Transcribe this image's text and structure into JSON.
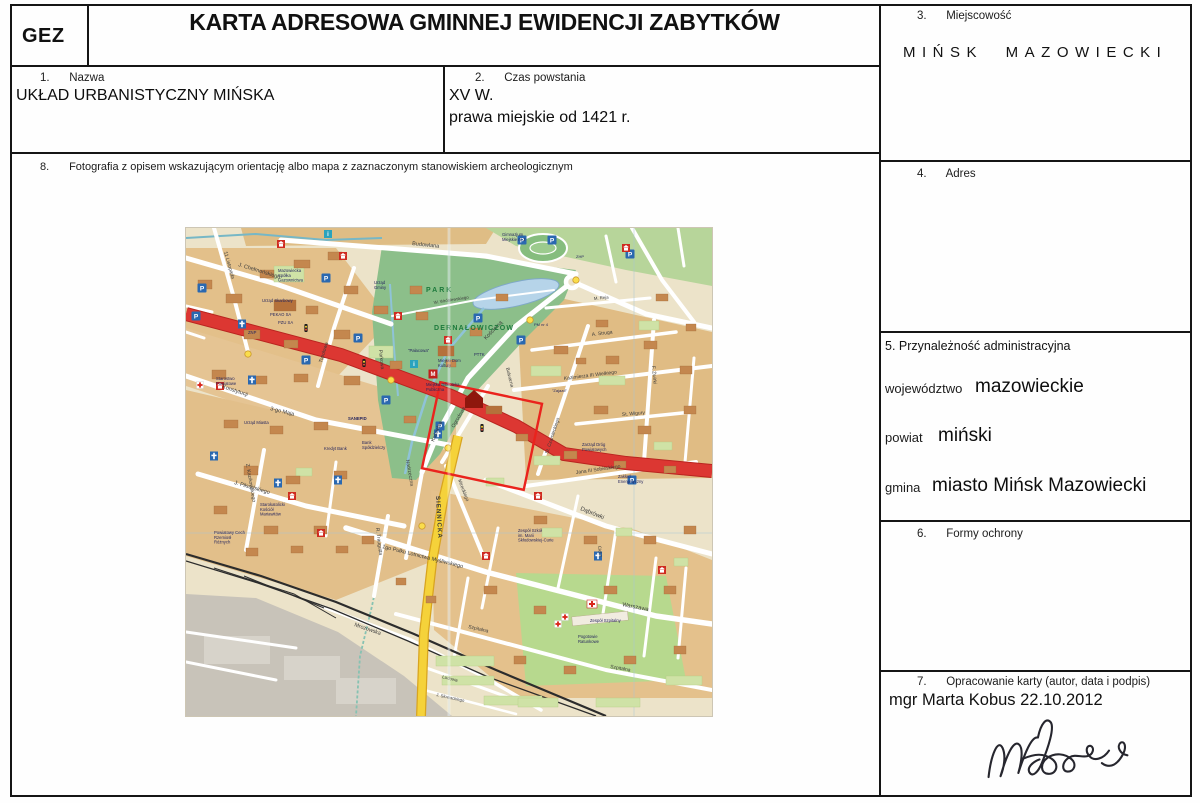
{
  "doc": {
    "gez": "GEZ",
    "title": "KARTA ADRESOWA GMINNEJ EWIDENCJI ZABYTKÓW"
  },
  "fields": {
    "nazwa": {
      "num": "1.",
      "label": "Nazwa",
      "value": "UKŁAD URBANISTYCZNY MIŃSKA"
    },
    "czas": {
      "num": "2.",
      "label": "Czas powstania",
      "value1": "XV W.",
      "value2": "prawa miejskie od 1421 r."
    },
    "miejscowosc": {
      "num": "3.",
      "label": "Miejscowość",
      "value": "MIŃSK MAZOWIECKI"
    },
    "adres": {
      "num": "4.",
      "label": "Adres"
    },
    "przynaleznosc": {
      "label": "5. Przynależność administracyjna",
      "rows": [
        {
          "label": "województwo",
          "value": "mazowieckie"
        },
        {
          "label": "powiat",
          "value": "miński"
        },
        {
          "label": "gmina",
          "value": "miasto Mińsk Mazowiecki"
        }
      ]
    },
    "formy": {
      "num": "6.",
      "label": "Formy ochrony"
    },
    "opracowanie": {
      "num": "7.",
      "label": "Opracowanie karty (autor, data i podpis)",
      "value": "mgr Marta Kobus 22.10.2012"
    },
    "fotografia": {
      "num": "8.",
      "label": "Fotografia z opisem wskazującym orientację albo mapa z zaznaczonym stanowiskiem archeologicznym"
    }
  },
  "map": {
    "colors": {
      "base": "#ece3c9",
      "block": "#e2c08a",
      "park": "#8cbf8a",
      "water": "#b6d4e9",
      "road_red": "#dc3732",
      "road_yellow": "#f5d23a",
      "rail": "#2c2c2c",
      "monument_outline": "#ea231d",
      "industrial": "#c8c3b9"
    },
    "labels": [
      {
        "t": "J. Chełmońskiego",
        "x": 52,
        "y": 38,
        "r": 17,
        "s": 5.5
      },
      {
        "t": "11 Listopada",
        "x": 38,
        "y": 24,
        "r": 74,
        "s": 5
      },
      {
        "t": "Topolowa",
        "x": 136,
        "y": 135,
        "r": -73,
        "s": 5
      },
      {
        "t": "Budowlana",
        "x": 226,
        "y": 17,
        "r": 6,
        "s": 5.5
      },
      {
        "t": "W. Wróblewskiego",
        "x": 248,
        "y": 76,
        "r": -9,
        "s": 4.3
      },
      {
        "t": "Kościelna",
        "x": 300,
        "y": 112,
        "r": -46,
        "s": 5.5
      },
      {
        "t": "Kościelna",
        "x": 248,
        "y": 214,
        "r": -68,
        "s": 5
      },
      {
        "t": "Parkowa",
        "x": 193,
        "y": 122,
        "r": 84,
        "s": 5
      },
      {
        "t": "Konstytucji",
        "x": 36,
        "y": 160,
        "r": 18,
        "s": 5.5
      },
      {
        "t": "3-go Maja",
        "x": 84,
        "y": 182,
        "r": 14,
        "s": 5.5
      },
      {
        "t": "Z. Kazikowskiego",
        "x": 60,
        "y": 236,
        "r": 80,
        "s": 5
      },
      {
        "t": "J. Piłsudskiego",
        "x": 48,
        "y": 256,
        "r": 16,
        "s": 5.5
      },
      {
        "t": "R. Traugutta",
        "x": 190,
        "y": 300,
        "r": 83,
        "s": 5
      },
      {
        "t": "Mireckiego",
        "x": 272,
        "y": 252,
        "r": 69,
        "s": 4.8
      },
      {
        "t": "Nadrzeczna",
        "x": 220,
        "y": 232,
        "r": 80,
        "s": 5
      },
      {
        "t": "Ogrodowa",
        "x": 268,
        "y": 200,
        "r": -60,
        "s": 5
      },
      {
        "t": "St. Czarnieckiego",
        "x": 362,
        "y": 226,
        "r": -72,
        "s": 4.8
      },
      {
        "t": "M. Reja",
        "x": 408,
        "y": 72,
        "r": -6,
        "s": 4.3
      },
      {
        "t": "A. Struga",
        "x": 406,
        "y": 108,
        "r": -7,
        "s": 5
      },
      {
        "t": "Kazimierza III Wielkiego",
        "x": 378,
        "y": 152,
        "r": -7,
        "s": 5
      },
      {
        "t": "F. Żwirki",
        "x": 466,
        "y": 138,
        "r": 85,
        "s": 5
      },
      {
        "t": "St. Wigury",
        "x": 436,
        "y": 188,
        "r": -5,
        "s": 5
      },
      {
        "t": "Jana III Sobieskiego",
        "x": 390,
        "y": 246,
        "r": -8,
        "s": 5
      },
      {
        "t": "Bulwarna",
        "x": 320,
        "y": 140,
        "r": 76,
        "s": 4.8
      },
      {
        "t": "Dąbrówki",
        "x": 394,
        "y": 282,
        "r": 22,
        "s": 6
      },
      {
        "t": "1go Pułku Lotnictwa Myśliwskiego",
        "x": 196,
        "y": 320,
        "r": 14,
        "s": 5.5
      },
      {
        "t": "Warszawa",
        "x": 436,
        "y": 378,
        "r": 11,
        "s": 5.8
      },
      {
        "t": "Mrozowska",
        "x": 168,
        "y": 398,
        "r": 19,
        "s": 5.5
      },
      {
        "t": "Szpitalna",
        "x": 282,
        "y": 400,
        "r": 13,
        "s": 5
      },
      {
        "t": "Szpitalna",
        "x": 424,
        "y": 440,
        "r": 10,
        "s": 5
      },
      {
        "t": "SIENNICKA",
        "x": 250,
        "y": 268,
        "r": 87,
        "s": 6.2,
        "w": 700,
        "ls": 1
      },
      {
        "t": "Cicha",
        "x": 412,
        "y": 318,
        "r": 83,
        "s": 4.5
      },
      {
        "t": "Ludowa",
        "x": 256,
        "y": 450,
        "r": 14,
        "s": 4.5
      },
      {
        "t": "J. Słowackiego",
        "x": 250,
        "y": 468,
        "r": 12,
        "s": 4.3
      },
      {
        "t": "PARK",
        "x": 240,
        "y": 64,
        "s": 7,
        "c": "#1d7a3c",
        "w": 700,
        "ls": 2
      },
      {
        "t": "DERNAŁOWICZÓW",
        "x": 248,
        "y": 102,
        "s": 7,
        "c": "#1d7a3c",
        "w": 700,
        "ls": 1.2
      },
      {
        "t": "Mazowiecka\nSpółka\nGazownictwa",
        "x": 92,
        "y": 44,
        "p": 1
      },
      {
        "t": "Urząd Skarbowy",
        "x": 76,
        "y": 74,
        "p": 1
      },
      {
        "t": "Urząd\nGminy",
        "x": 188,
        "y": 56,
        "p": 1
      },
      {
        "t": "Gimnazjum\nMiejskie nr 2",
        "x": 316,
        "y": 8,
        "p": 1
      },
      {
        "t": "PEKAO SA",
        "x": 84,
        "y": 88,
        "p": 1
      },
      {
        "t": "PZU SA",
        "x": 92,
        "y": 96,
        "p": 1
      },
      {
        "t": "ZNP",
        "x": 62,
        "y": 106,
        "p": 1
      },
      {
        "t": "Starostwo\nPowiatowe",
        "x": 30,
        "y": 152,
        "p": 1
      },
      {
        "t": "Urząd Miasta",
        "x": 58,
        "y": 196,
        "p": 1
      },
      {
        "t": "Miejski Dom\nKultury",
        "x": 252,
        "y": 134,
        "p": 1
      },
      {
        "t": "Miejska Biblioteka\nPubliczna",
        "x": 240,
        "y": 158,
        "p": 1
      },
      {
        "t": "PTTK",
        "x": 288,
        "y": 128,
        "p": 1
      },
      {
        "t": "\"Pałacowa\"",
        "x": 222,
        "y": 124,
        "p": 1
      },
      {
        "t": "SANEPID",
        "x": 162,
        "y": 192,
        "p": 1,
        "w": 700
      },
      {
        "t": "Kredyt Bank",
        "x": 138,
        "y": 222,
        "p": 1
      },
      {
        "t": "Bank\nSpółdzielczy",
        "x": 176,
        "y": 216,
        "p": 1
      },
      {
        "t": "Starokatolicki\nKościół\nMariawitów",
        "x": 74,
        "y": 278,
        "p": 1
      },
      {
        "t": "Powiatowy Cech\nRzemiosł\nRóżnych",
        "x": 28,
        "y": 306,
        "p": 1
      },
      {
        "t": "Zespół Szkół\nim. Marii\nSkłodowskiej-Curie",
        "x": 332,
        "y": 304,
        "p": 1
      },
      {
        "t": "Zarząd Dróg\nPowiatowych",
        "x": 396,
        "y": 218,
        "p": 1
      },
      {
        "t": "Zakład\nEnergetyczny",
        "x": 432,
        "y": 250,
        "p": 1
      },
      {
        "t": "Zespół Szpitalny",
        "x": 404,
        "y": 394,
        "p": 1
      },
      {
        "t": "Pogotowie\nRatunkowe",
        "x": 392,
        "y": 410,
        "p": 1
      },
      {
        "t": "PM nr 4",
        "x": 348,
        "y": 98,
        "p": 1,
        "s": 4
      },
      {
        "t": "\"Zajazd\"",
        "x": 366,
        "y": 164,
        "p": 1,
        "s": 4
      },
      {
        "t": "ZHP",
        "x": 390,
        "y": 30,
        "p": 1,
        "s": 4
      }
    ],
    "icons": [
      {
        "k": "parking",
        "x": 16,
        "y": 60
      },
      {
        "k": "parking",
        "x": 10,
        "y": 88
      },
      {
        "k": "parking",
        "x": 140,
        "y": 50
      },
      {
        "k": "parking",
        "x": 172,
        "y": 110
      },
      {
        "k": "parking",
        "x": 292,
        "y": 90
      },
      {
        "k": "parking",
        "x": 336,
        "y": 12
      },
      {
        "k": "parking",
        "x": 366,
        "y": 12
      },
      {
        "k": "parking",
        "x": 200,
        "y": 172
      },
      {
        "k": "parking",
        "x": 254,
        "y": 198
      },
      {
        "k": "parking",
        "x": 446,
        "y": 252
      },
      {
        "k": "parking",
        "x": 120,
        "y": 132
      },
      {
        "k": "parking",
        "x": 335,
        "y": 112
      },
      {
        "k": "parking",
        "x": 444,
        "y": 26
      },
      {
        "k": "church",
        "x": 56,
        "y": 96
      },
      {
        "k": "church",
        "x": 66,
        "y": 152
      },
      {
        "k": "church",
        "x": 28,
        "y": 228
      },
      {
        "k": "church",
        "x": 152,
        "y": 252
      },
      {
        "k": "church",
        "x": 252,
        "y": 206
      },
      {
        "k": "church",
        "x": 412,
        "y": 328
      },
      {
        "k": "church",
        "x": 92,
        "y": 255
      },
      {
        "k": "poi",
        "x": 34,
        "y": 158
      },
      {
        "k": "poi",
        "x": 95,
        "y": 16
      },
      {
        "k": "poi",
        "x": 157,
        "y": 28
      },
      {
        "k": "poi",
        "x": 212,
        "y": 88
      },
      {
        "k": "poi",
        "x": 262,
        "y": 112
      },
      {
        "k": "poi",
        "x": 352,
        "y": 268
      },
      {
        "k": "poi",
        "x": 440,
        "y": 20
      },
      {
        "k": "poi",
        "x": 300,
        "y": 328
      },
      {
        "k": "poi",
        "x": 476,
        "y": 342
      },
      {
        "k": "poi",
        "x": 106,
        "y": 268
      },
      {
        "k": "poi",
        "x": 135,
        "y": 305
      },
      {
        "k": "museum",
        "x": 247,
        "y": 146
      },
      {
        "k": "hospital",
        "x": 406,
        "y": 376
      },
      {
        "k": "cross",
        "x": 372,
        "y": 396
      },
      {
        "k": "cross",
        "x": 379,
        "y": 389
      },
      {
        "k": "cross",
        "x": 14,
        "y": 157
      },
      {
        "k": "tlight",
        "x": 120,
        "y": 100
      },
      {
        "k": "tlight",
        "x": 178,
        "y": 135
      },
      {
        "k": "tlight",
        "x": 296,
        "y": 200
      },
      {
        "k": "dot",
        "x": 62,
        "y": 126
      },
      {
        "k": "dot",
        "x": 205,
        "y": 152
      },
      {
        "k": "dot",
        "x": 262,
        "y": 220
      },
      {
        "k": "dot",
        "x": 236,
        "y": 298
      },
      {
        "k": "dot",
        "x": 344,
        "y": 92
      },
      {
        "k": "dot",
        "x": 390,
        "y": 52
      },
      {
        "k": "info",
        "x": 142,
        "y": 6
      },
      {
        "k": "info",
        "x": 228,
        "y": 136
      }
    ]
  }
}
